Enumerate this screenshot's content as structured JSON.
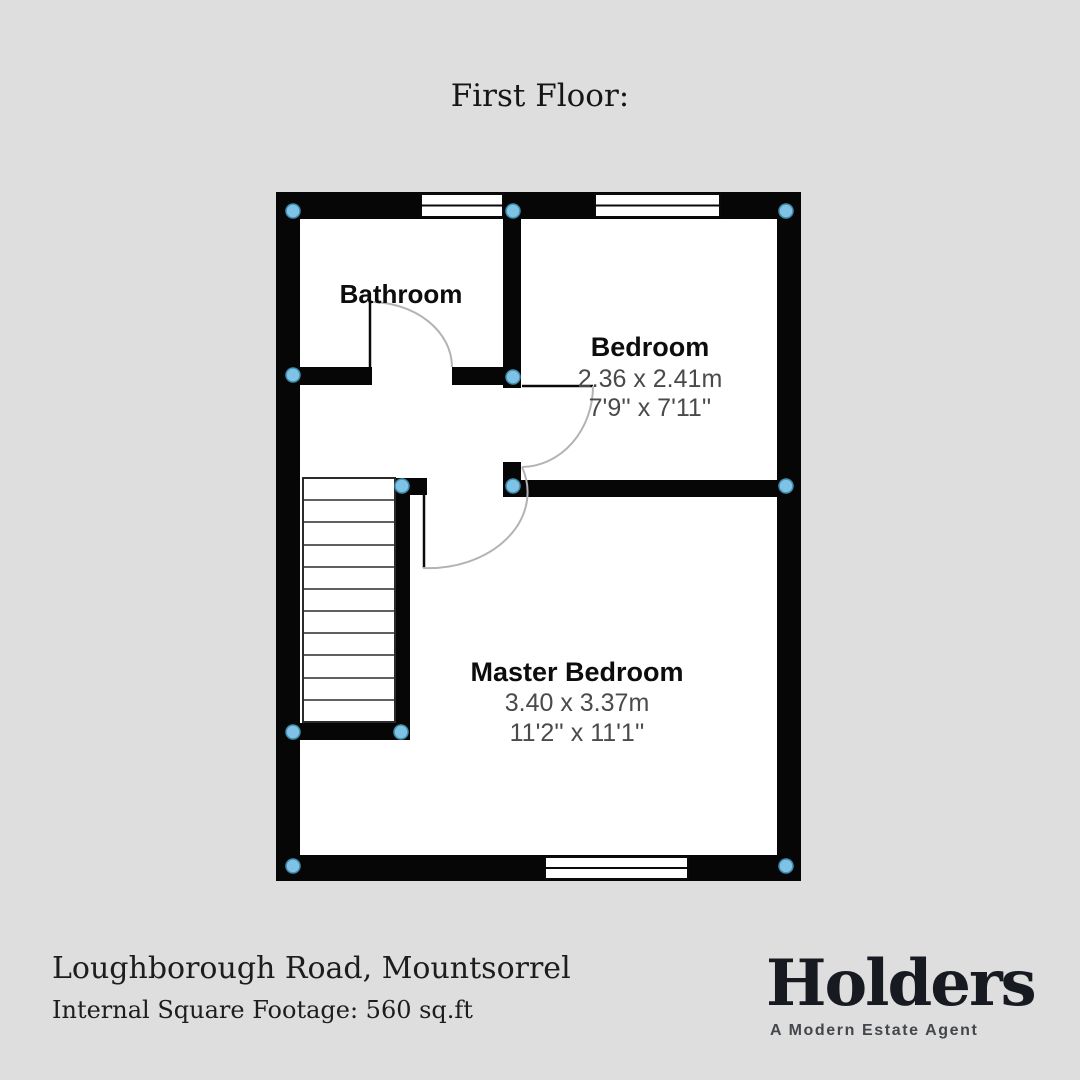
{
  "background_color": "#dedede",
  "title": "First Floor:",
  "floorplan": {
    "bathroom": {
      "name": "Bathroom"
    },
    "bedroom": {
      "name": "Bedroom",
      "dim_metric": "2.36 x 2.41m",
      "dim_imperial": "7'9'' x 7'11''"
    },
    "master_bedroom": {
      "name": "Master Bedroom",
      "dim_metric": "3.40 x 3.37m",
      "dim_imperial": "11'2'' x 11'1''"
    },
    "features": {
      "windows": 3,
      "doors": 3,
      "staircase_steps": 11,
      "corner_markers": 12
    },
    "colors": {
      "wall": "#060606",
      "floor": "#ffffff",
      "marker_fill": "#7ec3e6",
      "marker_stroke": "#418cae",
      "door_arc": "#b3b3b3",
      "dimension_text": "#4a4a4a"
    }
  },
  "footer": {
    "address": "Loughborough Road, Mountsorrel",
    "square_footage": "Internal Square Footage: 560 sq.ft",
    "logo": {
      "wordmark": "Holders",
      "tagline": "A Modern Estate Agent"
    }
  }
}
